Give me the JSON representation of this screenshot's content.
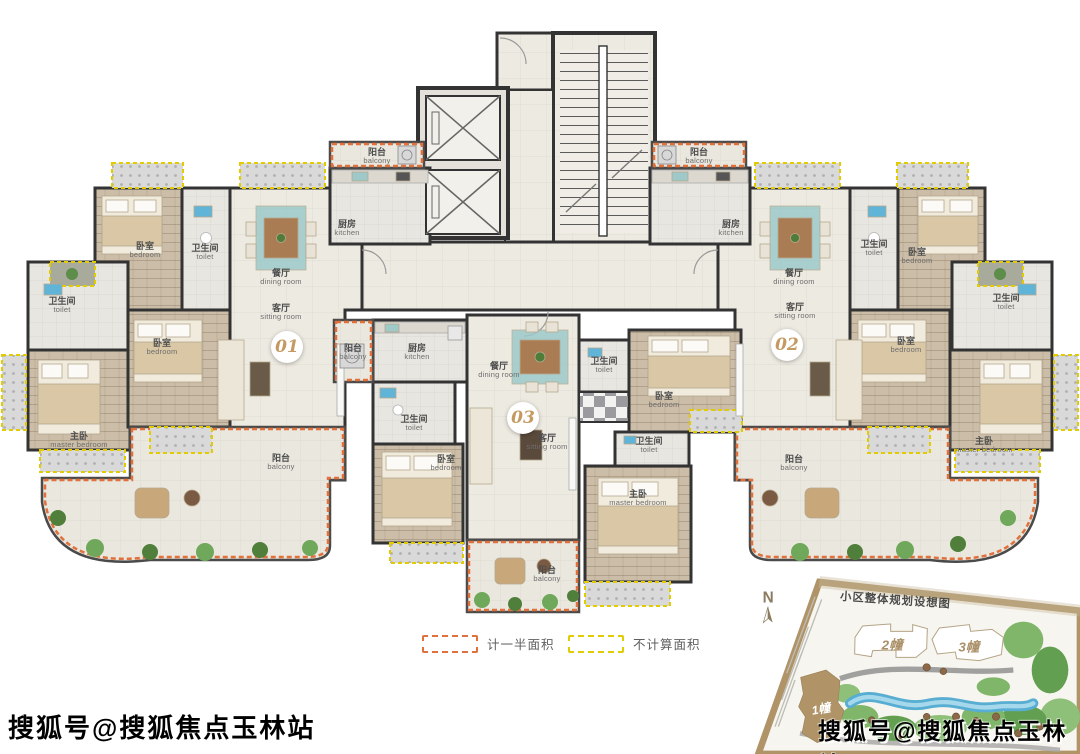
{
  "plan": {
    "unit_badges": [
      {
        "number": "01"
      },
      {
        "number": "02"
      },
      {
        "number": "03"
      }
    ],
    "rooms": [
      {
        "cn": "卧室",
        "en": "bedroom"
      },
      {
        "cn": "卫生间",
        "en": "toilet"
      },
      {
        "cn": "餐厅",
        "en": "dining room"
      },
      {
        "cn": "客厅",
        "en": "sitting room"
      },
      {
        "cn": "厨房",
        "en": "kitchen"
      },
      {
        "cn": "阳台",
        "en": "balcony"
      },
      {
        "cn": "卫生间",
        "en": "toilet"
      },
      {
        "cn": "卧室",
        "en": "bedroom"
      },
      {
        "cn": "主卧",
        "en": "master bedroom"
      },
      {
        "cn": "阳台",
        "en": "balcony"
      },
      {
        "cn": "阳台",
        "en": "balcony"
      },
      {
        "cn": "厨房",
        "en": "kitchen"
      },
      {
        "cn": "餐厅",
        "en": "dining room"
      },
      {
        "cn": "卫生间",
        "en": "toilet"
      },
      {
        "cn": "卧室",
        "en": "bedroom"
      },
      {
        "cn": "客厅",
        "en": "sitting room"
      },
      {
        "cn": "卫生间",
        "en": "toilet"
      },
      {
        "cn": "卧室",
        "en": "bedroom"
      },
      {
        "cn": "卫生间",
        "en": "toilet"
      },
      {
        "cn": "主卧",
        "en": "master bedroom"
      },
      {
        "cn": "阳台",
        "en": "balcony"
      },
      {
        "cn": "阳台",
        "en": "balcony"
      },
      {
        "cn": "厨房",
        "en": "kitchen"
      },
      {
        "cn": "餐厅",
        "en": "dining room"
      },
      {
        "cn": "客厅",
        "en": "sitting room"
      },
      {
        "cn": "卫生间",
        "en": "toilet"
      },
      {
        "cn": "卧室",
        "en": "bedroom"
      },
      {
        "cn": "卫生间",
        "en": "toilet"
      },
      {
        "cn": "卧室",
        "en": "bedroom"
      },
      {
        "cn": "主卧",
        "en": "master bedroom"
      },
      {
        "cn": "阳台",
        "en": "balcony"
      }
    ]
  },
  "legend": {
    "half_area": "计一半面积",
    "excluded_area": "不计算面积"
  },
  "site_plan": {
    "title": "小区整体规划设想图",
    "compass": "N",
    "buildings": [
      {
        "label": "1幢"
      },
      {
        "label": "2幢"
      },
      {
        "label": "3幢"
      }
    ]
  },
  "watermarks": {
    "bottom_left": "搜狐号@搜狐焦点玉林站",
    "bottom_right": "搜狐号@搜狐焦点玉林站"
  },
  "colors": {
    "wall": "#333333",
    "half_area_dash": "#e0713c",
    "excluded_area_dash": "#e0cc00",
    "unit_badge_text": "#c49a62",
    "site_boundary": "#b09468"
  }
}
